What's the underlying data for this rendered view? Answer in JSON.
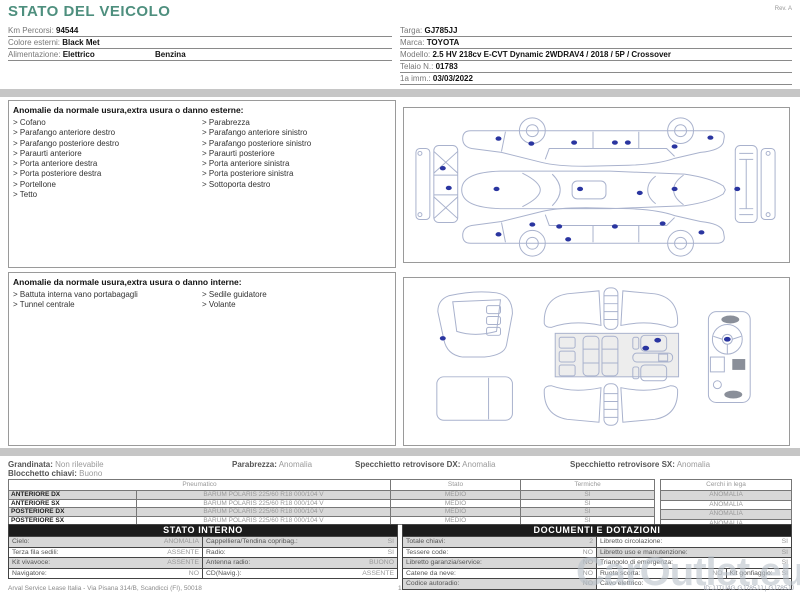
{
  "page": {
    "title": "STATO DEL VEICOLO",
    "rev": "Rev. A",
    "watermark": "CarOutlet.eu"
  },
  "vehicle": {
    "km": {
      "label": "Km Percorsi:",
      "value": "94544"
    },
    "color": {
      "label": "Colore esterni:",
      "value": "Black Met"
    },
    "fuel": {
      "label": "Alimentazione:",
      "value1": "Elettrico",
      "value2": "Benzina"
    },
    "targa": {
      "label": "Targa:",
      "value": "GJ785JJ"
    },
    "marca": {
      "label": "Marca:",
      "value": "TOYOTA"
    },
    "modello": {
      "label": "Modello:",
      "value": "2.5 HV 218cv E-CVT Dynamic 2WDRAV4 / 2018 / 5P / Crossover"
    },
    "telaio": {
      "label": "Telaio N.:",
      "value": "01783"
    },
    "prima_imm": {
      "label": "1a imm.:",
      "value": "03/03/2022"
    }
  },
  "exterior_anomalies": {
    "title": "Anomalie da normale usura,extra usura o danno esterne:",
    "left": [
      "Cofano",
      "Parafango anteriore destro",
      "Parafango posteriore destro",
      "Paraurti anteriore",
      "Porta anteriore destra",
      "Porta posteriore destra",
      "Portellone",
      "Tetto"
    ],
    "right": [
      "Parabrezza",
      "Parafango anteriore sinistro",
      "Parafango posteriore sinistro",
      "Paraurti posteriore",
      "Porta anteriore sinistra",
      "Porta posteriore sinistra",
      "Sottoporta destro"
    ]
  },
  "interior_anomalies": {
    "title": "Anomalie da normale usura,extra usura o danno interne:",
    "left": [
      "Battuta interna vano portabagagli",
      "Tunnel centrale"
    ],
    "right": [
      "Sedile guidatore",
      "Volante"
    ]
  },
  "conditions": {
    "grandinata": {
      "label": "Grandinata:",
      "value": "Non rilevabile"
    },
    "parabrezza": {
      "label": "Parabrezza:",
      "value": "Anomalia"
    },
    "specchietto_dx": {
      "label": "Specchietto retrovisore DX:",
      "value": "Anomalia"
    },
    "specchietto_sx": {
      "label": "Specchietto retrovisore SX:",
      "value": "Anomalia"
    },
    "blocchetto": {
      "label": "Blocchetto chiavi:",
      "value": "Buono"
    }
  },
  "tires": {
    "headers": {
      "pneumatico": "Pneumatico",
      "stato": "Stato",
      "termiche": "Termiche",
      "cerchi": "Cerchi in lega"
    },
    "rows": [
      {
        "position": "ANTERIORE DX",
        "tire": "BARUM POLARIS 225/60 R18 000/104 V",
        "stato": "MEDIO",
        "termiche": "SI",
        "cerchi": "ANOMALIA"
      },
      {
        "position": "ANTERIORE SX",
        "tire": "BARUM POLARIS 225/60 R18 000/104 V",
        "stato": "MEDIO",
        "termiche": "SI",
        "cerchi": "ANOMALIA"
      },
      {
        "position": "POSTERIORE DX",
        "tire": "BARUM POLARIS 225/60 R18 000/104 V",
        "stato": "MEDIO",
        "termiche": "SI",
        "cerchi": "ANOMALIA"
      },
      {
        "position": "POSTERIORE SX",
        "tire": "BARUM POLARIS 225/60 R18 000/104 V",
        "stato": "MEDIO",
        "termiche": "SI",
        "cerchi": "ANOMALIA"
      }
    ]
  },
  "stato_interno": {
    "title": "STATO INTERNO",
    "rows": [
      {
        "l1": "Cielo:",
        "v1": "ANOMALIA",
        "l2": "Cappelliera/Tendina copribag.:",
        "v2": "SI"
      },
      {
        "l1": "Terza fila sedili:",
        "v1": "ASSENTE",
        "l2": "Radio:",
        "v2": "SI"
      },
      {
        "l1": "Kit vivavoce:",
        "v1": "ASSENTE",
        "l2": "Antenna radio:",
        "v2": "BUONO"
      },
      {
        "l1": "Navigatore:",
        "v1": "NO",
        "l2": "CD(Navig.):",
        "v2": "ASSENTE"
      }
    ]
  },
  "documenti": {
    "title": "DOCUMENTI E DOTAZIONI",
    "rows": [
      {
        "l1": "Totale chiavi:",
        "v1": "2",
        "l2": "Libretto circolazione:",
        "v2": "SI"
      },
      {
        "l1": "Tessere code:",
        "v1": "NO",
        "l2": "Libretto uso e manutenzione:",
        "v2": "SI"
      },
      {
        "l1": "Libretto garanzia/service:",
        "v1": "NO",
        "l2": "Triangolo di emergenza:",
        "v2": "SI"
      },
      {
        "l1": "Catene da neve:",
        "v1": "NO",
        "l2": "Ruota scorta:",
        "v2": "NO",
        "l3": "Kit gonfiaggio:",
        "v3": "SI"
      },
      {
        "l1": "Codice autoradio:",
        "v1": "NO",
        "l2": "Cavo elettrico:",
        "v2": ""
      }
    ]
  },
  "footer": {
    "company": "Arval Service Lease Italia - Via Pisana 314/B, Scandicci (FI), 50018",
    "page_number": "1",
    "doc_id": "ID:JJTU4G GJ785JJ | GJ785JJ"
  }
}
